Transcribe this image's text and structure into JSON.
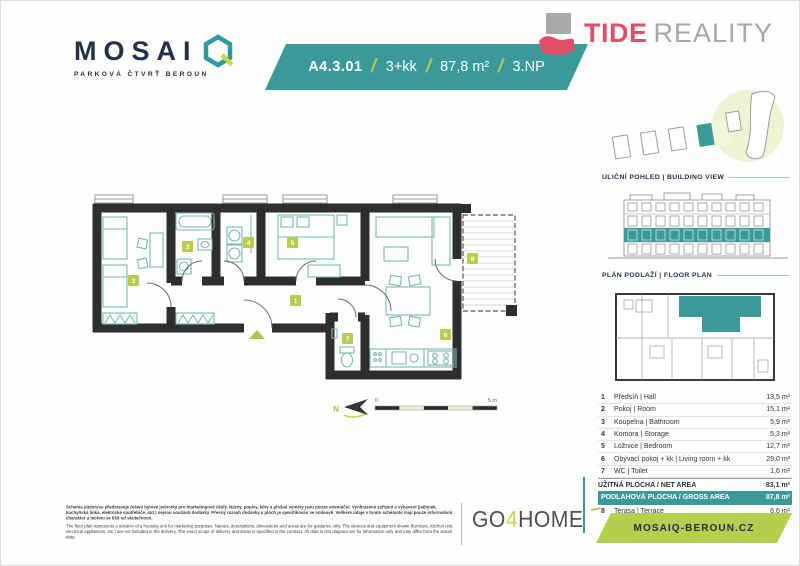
{
  "header": {
    "brand": {
      "wordmark": "MOSAI",
      "subtitle": "PARKOVÁ ČTVRŤ BEROUN"
    },
    "unit_banner": {
      "unit": "A4.3.01",
      "sep": "/",
      "disposition": "3+kk",
      "area": "87,8 m²",
      "floor": "3.NP"
    },
    "agency": {
      "primary": "TIDE",
      "secondary": "REALITY"
    }
  },
  "sidebar": {
    "building_view_heading": "ULIČNÍ POHLED  |  BUILDING VIEW",
    "floor_plan_heading": "PLÁN PODLAŽÍ  |  FLOOR PLAN"
  },
  "floor_plan": {
    "north": "N",
    "scale": {
      "start": "0",
      "end": "5 m"
    },
    "badges": [
      "1",
      "2",
      "3",
      "4",
      "5",
      "6",
      "7",
      "8"
    ]
  },
  "table": {
    "rooms": [
      {
        "num": "1",
        "name": "Předsíň | Hall",
        "area": "13,5 m²"
      },
      {
        "num": "2",
        "name": "Pokoj | Room",
        "area": "15,1 m²"
      },
      {
        "num": "3",
        "name": "Koupelna | Bathroom",
        "area": "5,9 m²"
      },
      {
        "num": "4",
        "name": "Komora | Storage",
        "area": "5,3 m²"
      },
      {
        "num": "5",
        "name": "Ložnice | Bedroom",
        "area": "12,7 m²"
      },
      {
        "num": "6",
        "name": "Obývací pokoj + kk | Living room + kk",
        "area": "29,0 m²"
      },
      {
        "num": "7",
        "name": "WC | Toilet",
        "area": "1,6 m²"
      }
    ],
    "net": {
      "label": "UŽITNÁ PLOCHA / NET AREA",
      "area": "83,1 m²"
    },
    "gross": {
      "label": "PODLAHOVÁ PLOCHA / GROSS AREA",
      "area": "87,8 m²"
    },
    "terrace": {
      "num": "8",
      "name": "Terasa | Terrace",
      "area": "6,6 m²"
    }
  },
  "footer": {
    "disclaimer_cs": "Schéma půdorysu představuje řešení bytové jednotky pro marketingové účely. Názvy, popisy, kóty a plošné výměry jsou pouze orientační. Vyobrazená zařízení a vybavení (nábytek, kuchyňská linka, elektrické spotřebiče, atd.) nejsou součástí dodávky. Přesný rozsah dodávky a ploch je specifikován ve smlouvě. Veškeré údaje v tomto schématu mají pouze informativní charakter a mohou se lišit od skutečnosti.",
    "disclaimer_en": "The floor plan represents a solution of a housing unit for marketing purposes. Names, descriptions, dimensions and areas are for guidance only. The devices and equipment shown (furniture, kitchen unit, electrical appliances, etc.) are not included in the delivery. The exact scope of delivery and areas is specified in the contract. All data in this diagram are for information only and may differ from the actual data.",
    "partner": {
      "go": "GO",
      "four": "4",
      "home": "HOME"
    },
    "website": "MOSAIQ-BEROUN.CZ"
  },
  "colors": {
    "teal": "#3a9a9a",
    "lime": "#b9cb4e",
    "navy": "#253049",
    "pink": "#df5068",
    "gray": "#a7a7a7"
  }
}
